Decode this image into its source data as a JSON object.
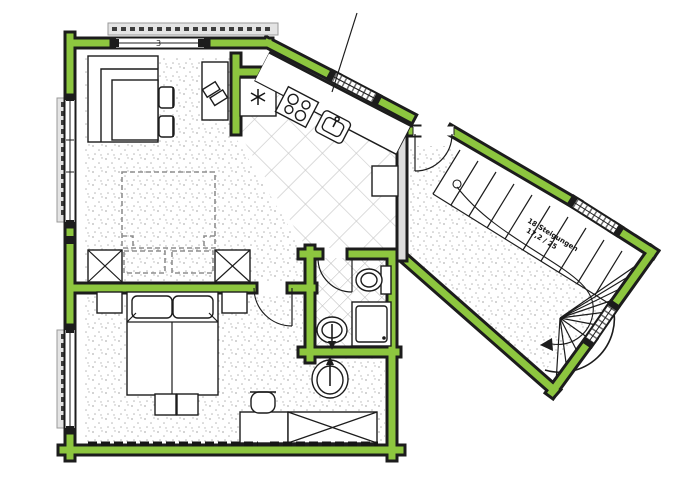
{
  "meta": {
    "type": "architectural floor plan",
    "description": "Apartment floor plan with green-highlighted exterior walls and angled stair hall",
    "canvas": {
      "width": 700,
      "height": 500
    }
  },
  "colors": {
    "wall-green": "#8DC63F",
    "line": "#1c1c1c",
    "gray-wall": "#dcdcdc",
    "tile": "#c9c9c9",
    "stipple": "#b5b5b5",
    "shutter": "#e4e4e4",
    "paper": "#ffffff"
  },
  "rooms": [
    {
      "id": "living-room",
      "floor": "stippled",
      "furniture": [
        "corner-bench",
        "dining-table",
        "two-chairs",
        "desk-with-papers",
        "dashed-bed-outline",
        "dashed-nightstands",
        "wardrobe-x-left",
        "wardrobe-x-right"
      ]
    },
    {
      "id": "kitchen",
      "floor": "diagonal-tiles",
      "furniture": [
        "refrigerator-snowflake",
        "counter",
        "stove-4-burner",
        "sink-with-faucet",
        "base-cabinet"
      ]
    },
    {
      "id": "bedroom",
      "floor": "stippled",
      "furniture": [
        "double-bed",
        "nightstand-left",
        "nightstand-right",
        "foot-stools",
        "desk",
        "desk-chair",
        "wardrobe-x",
        "washbasin"
      ]
    },
    {
      "id": "bathroom",
      "floor": "small-diagonal-tiles",
      "furniture": [
        "toilet",
        "shower",
        "washbasin"
      ]
    },
    {
      "id": "stair-hall",
      "floor": "stippled-landing",
      "furniture": [
        "winder-staircase"
      ]
    }
  ],
  "stairs": {
    "annotation_line1": "18 Steigungen",
    "annotation_line2": "17,2 / 25",
    "straight_treads": 11,
    "winder_treads": 9,
    "walk_line_start_circle": true
  },
  "openings": {
    "entry_door_count": 1,
    "interior_doors": [
      "bathroom-door",
      "bedroom-door"
    ],
    "window_count": 7
  },
  "markers": {
    "top_window_marker": "3"
  }
}
